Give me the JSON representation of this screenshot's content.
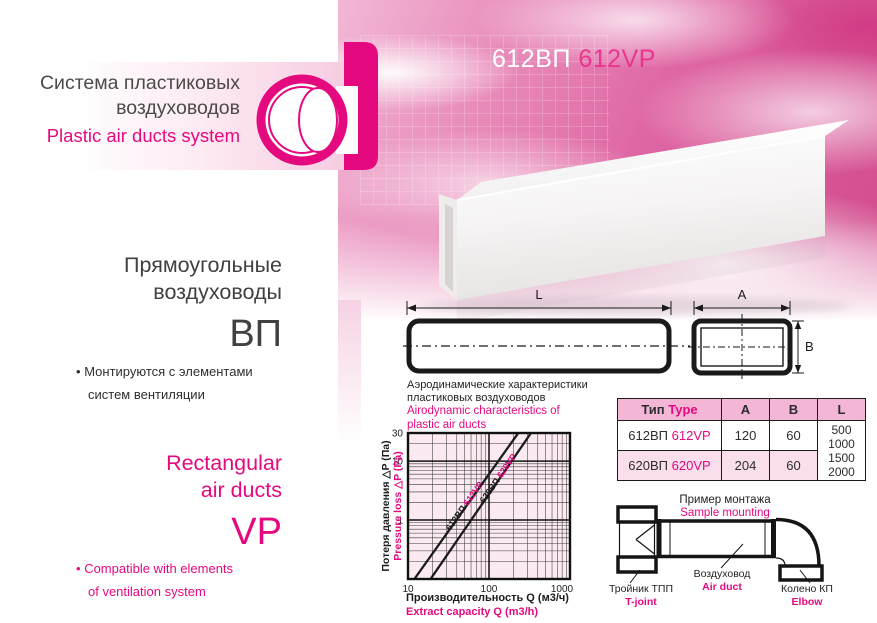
{
  "brand": {
    "title_ru_line1": "Система пластиковых",
    "title_ru_line2": "воздуховодов",
    "title_en": "Plastic air ducts system"
  },
  "product": {
    "code_ru": "612ВП",
    "code_en": "612VP"
  },
  "left_panel": {
    "heading_ru_line1": "Прямоугольные",
    "heading_ru_line2": "воздуховоды",
    "series_ru": "ВП",
    "bullet_char": "•",
    "bullet_ru_line1": "Монтируются с элементами",
    "bullet_ru_line2": "систем вентиляции",
    "heading_en_line1": "Rectangular",
    "heading_en_line2": "air ducts",
    "series_en": "VP",
    "bullet_en_line1": "Compatible with elements",
    "bullet_en_line2": "of ventilation system"
  },
  "dimensions": {
    "length_label": "L",
    "width_label": "A",
    "height_label": "B"
  },
  "chart_data": {
    "type": "line",
    "title_ru_line1": "Аэродинамические характеристики",
    "title_ru_line2": "пластиковых воздуховодов",
    "title_en_line1": "Airodynamic characteristics of",
    "title_en_line2": "plastic air ducts",
    "xlabel_ru": "Производительность Q (м3/ч)",
    "xlabel_en": "Extract capacity Q (m3/h)",
    "ylabel_ru": "Потеря давления △P (Па)",
    "ylabel_en": "Pressure loss △P (Pa)",
    "x_scale": "log",
    "y_scale": "log",
    "xlim": [
      10,
      1000
    ],
    "ylim": [
      0.1,
      30
    ],
    "x_ticks": [
      10,
      100,
      1000
    ],
    "y_ticks": [
      1,
      10,
      30
    ],
    "grid": "log-minor-on",
    "legend_position": "on-line-labels",
    "series": [
      {
        "name_ru": "612ВП",
        "name_en": "612VP",
        "points": [
          [
            12,
            0.1
          ],
          [
            230,
            30
          ]
        ]
      },
      {
        "name_ru": "620ВП",
        "name_en": "620VP",
        "points": [
          [
            19,
            0.1
          ],
          [
            330,
            30
          ]
        ]
      }
    ]
  },
  "table": {
    "header": {
      "type_ru": "Тип",
      "type_en": "Type",
      "a": "A",
      "b": "B",
      "l": "L"
    },
    "rows": [
      {
        "type_ru": "612ВП",
        "type_en": "612VP",
        "a": "120",
        "b": "60"
      },
      {
        "type_ru": "620ВП",
        "type_en": "620VP",
        "a": "204",
        "b": "60"
      }
    ],
    "lengths": [
      "500",
      "1000",
      "1500",
      "2000"
    ]
  },
  "mounting": {
    "title_ru": "Пример монтажа",
    "title_en": "Sample mounting",
    "tjoint_ru": "Тройник ТПП",
    "tjoint_en": "T-joint",
    "duct_ru": "Воздуховод",
    "duct_en": "Air duct",
    "elbow_ru": "Колено КП",
    "elbow_en": "Elbow"
  },
  "colors": {
    "magenta": "#e5097f",
    "dark_text": "#3c3c3c",
    "line_black": "#1b1b1b",
    "chart_bg": "#fbeaf2",
    "table_header_bg": "#f3b6d5",
    "table_row_alt_bg": "#fbdeec",
    "cloud_pink": "#de64a2"
  }
}
